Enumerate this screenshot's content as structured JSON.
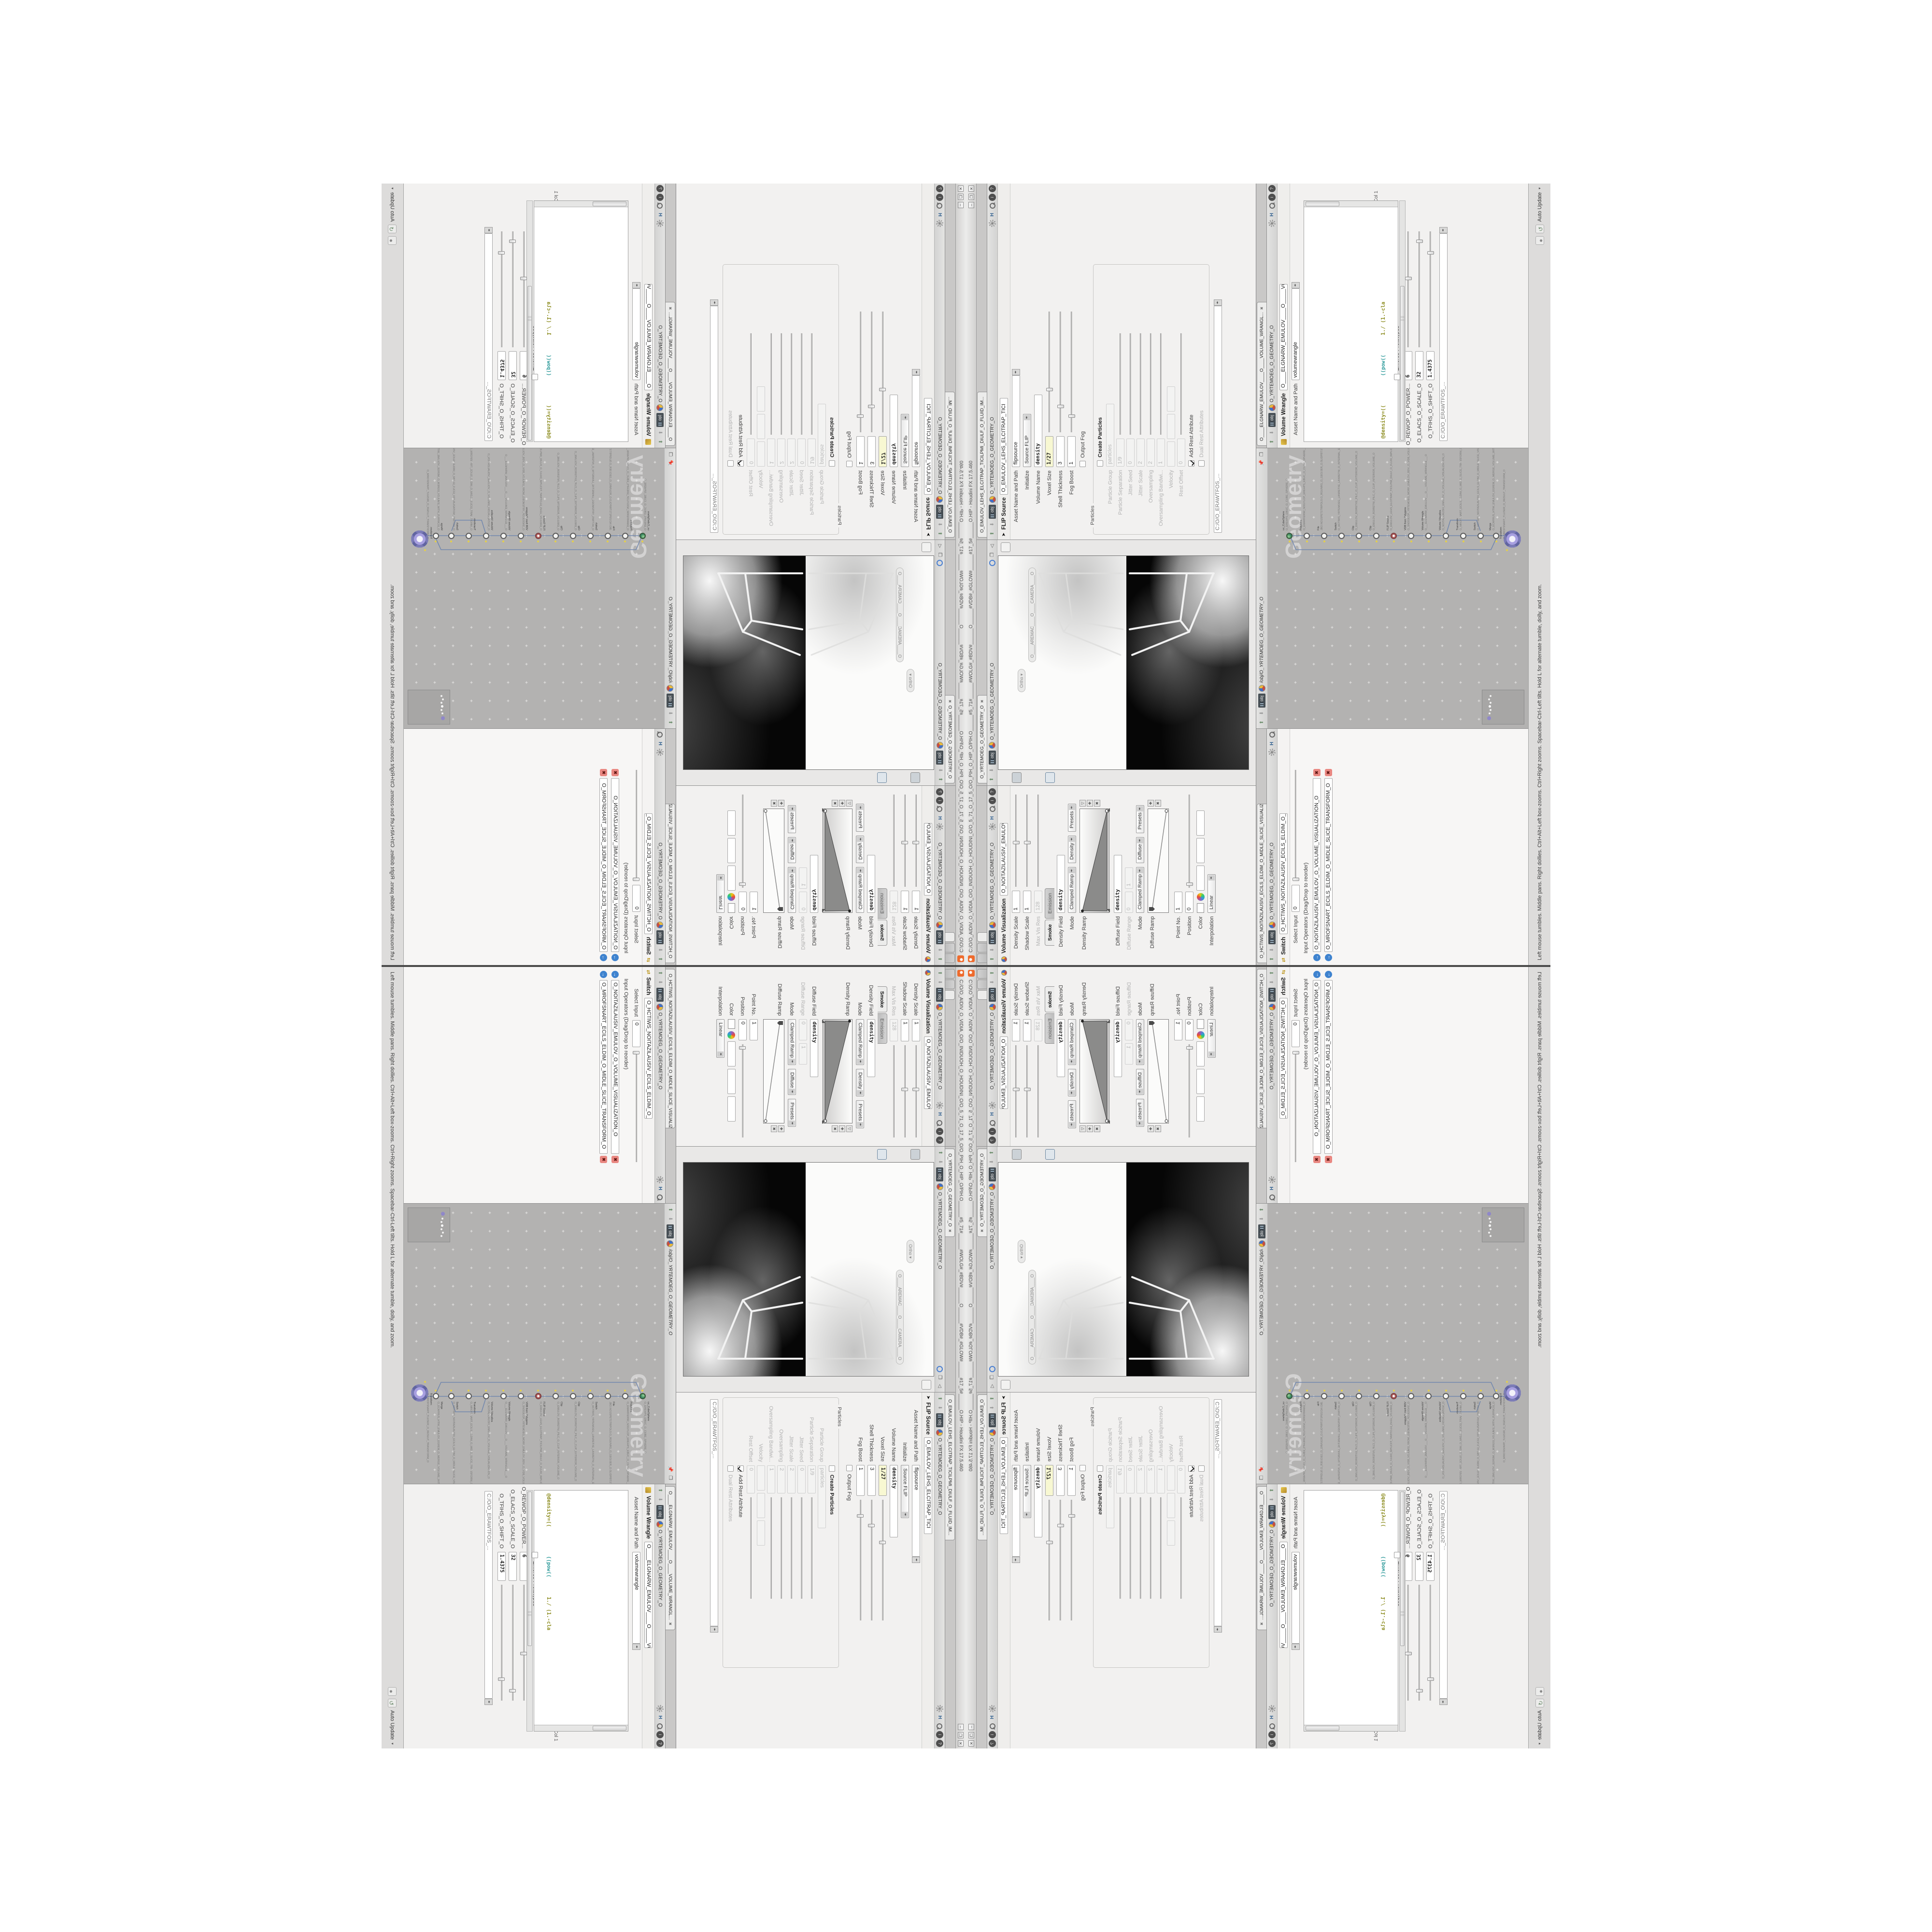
{
  "window": {
    "title": "C:/O/O_AIDIV_O_VIDIA_O/O_INIDUOH_O_HOUDINI_O/O_5_71_O_17_5_O/O_PIH_O_HIP_O/PIH.O______#5_71#______#WOLG#_#BDV#______O______#VDB#_#GLOW#______#17_5#______O.HIP - Houdini FX 17.5.460",
    "btn_min": "–",
    "btn_max": "❐",
    "btn_close": "✕"
  },
  "helpbar": {
    "hint": "Left mouse tumbles.  Middle pans.  Right dollies.  Ctrl+Alt+Left box-zooms.  Ctrl+Right zooms.  Spacebar-Ctrl-Left tilts.  Hold L for alternate tumble, dolly, and zoom.",
    "auto_update": "Auto Update"
  },
  "paths": {
    "obj": "obj",
    "geometry": "O_YRTEMOEG_O_GEOMETRY_O",
    "network_path": "/obj/O_YRTEMOEG_O_GEOMETRY_O",
    "software_path": "C:/O/O_ERAWTFOS_...",
    "h_badge": "H"
  },
  "param_tabs": [
    {
      "t": "O____ARTNAM____O..."
    },
    {
      "t": "O____AREMAC____O..."
    },
    {
      "t": "O_NOITAZILAUSIV_E...",
      "cls": "on"
    }
  ],
  "volviz": {
    "tab": "O_NOITAZILAUSIV_E...",
    "title": "Volume Visualization",
    "name": "O_NOITAZILAUSIV_EMULOV_O_VO",
    "density_scale_label": "Density Scale",
    "density_scale": "1",
    "shadow_scale_label": "Shadow Scale",
    "shadow_scale": "1",
    "maxvisres_label": "Max Vis Res",
    "maxvisres": "128",
    "folder_tabs": [
      "Smoke",
      "Emission"
    ],
    "density_field_label": "Density Field",
    "density_field": "density",
    "mode_label": "Mode",
    "mode": "Clamped Ramp",
    "density_btn": "Density",
    "diffuse_btn": "Diffuse",
    "presets_btn": "Presets",
    "density_ramp_label": "Density Ramp",
    "diffuse_field_label": "Diffuse Field",
    "diffuse_field": "density",
    "diffuse_range_label": "Diffuse Range",
    "diffuse_range_min": "0",
    "diffuse_range_max": "1",
    "diffuse_ramp_label": "Diffuse Ramp",
    "point_no_label": "Point No.",
    "point_no": "1",
    "position_label": "Position",
    "position": "0",
    "color_label": "Color",
    "color_vals": [
      "1.8125",
      "1.8125",
      "1.8125"
    ],
    "interp_label": "Interpolation",
    "interp": "Linear"
  },
  "viewport": {
    "tab": "O_YRTEMOEG_O_GEOMETRY_O",
    "pill_ortho": "Ortho ▾",
    "pill_camera": "O____AREMAC____O____CAMERA____O",
    "left_toolbar": [
      {
        "g": "●",
        "style": "color:#e3c44c"
      },
      {
        "g": "◆",
        "style": "color:#7f96a8;background:#ccd2d7;border:1px solid #8a8a8a"
      },
      {
        "g": "●",
        "style": "color:#d9b93f"
      },
      {
        "g": "▸",
        "style": "color:#f6f6f6;text-shadow:0 0 1px #666"
      },
      {
        "g": "D",
        "style": "color:#46688c;border:1px solid #6c87a0;background:#dfe6ec;font-size:10px"
      },
      {
        "g": "◎",
        "style": "color:#b04a38"
      },
      {
        "g": "►",
        "style": "color:#b04a38"
      },
      {
        "g": "✚",
        "style": "color:#53a253"
      },
      {
        "g": "∪",
        "style": "color:#c23d2e;font-weight:bold"
      },
      {
        "g": "∪",
        "style": "color:#c23d2e;font-weight:bold"
      },
      {
        "g": "∪",
        "style": "color:#c23d2e;font-weight:bold"
      },
      {
        "g": "∪",
        "style": "color:#c23d2e;font-weight:bold"
      },
      {
        "g": "✎",
        "style": "color:#8a8a8a"
      },
      {
        "g": "◉",
        "style": "color:#777"
      }
    ],
    "right_toolbar": [
      {
        "g": "▭",
        "style": "color:#555;border:1px solid #9a9a9a;background:#f2f2f1"
      },
      {
        "g": "●",
        "style": "color:#3f6fae"
      },
      {
        "g": "■",
        "style": "color:#7e9ab5"
      },
      {
        "g": "◎",
        "style": "color:#4a7fd1"
      },
      {
        "g": "▲",
        "style": "color:#8a8a89"
      },
      {
        "g": "●",
        "style": "color:#e0c454"
      },
      {
        "g": "◆",
        "style": "color:#97a5b2"
      },
      {
        "g": "●",
        "style": "color:#e0c454"
      },
      {
        "g": "□",
        "style": "color:#666"
      },
      {
        "g": "◉",
        "style": "color:#5588bb"
      }
    ]
  },
  "network": {
    "path": "/obj/O_YRTEMOEG_O_GEOMETRY_O",
    "watermark": "Geometry",
    "nodes": [
      {
        "type": "uv_CubeSphere",
        "name": "O_EREHPS_EBUC_O_CUBE_SPHERE_O",
        "style": "top:38px",
        "cls": "globe"
      },
      {
        "type": "PolyWire",
        "name": "O_EMARFERIW_NOGYLOP_EREHPS_EBUC_O_CUBE_SPHERE_POLYGON_WIREFRAME_O",
        "style": "top:74px"
      },
      {
        "type": "File",
        "name": "JBO.NO1SPET1TRIPOLS.O_RGUNRG_O_GEO/JER_O.SLIDPBT.STEP.3014.OBJ",
        "style": "top:110px"
      },
      {
        "type": "Switch",
        "name": "O_HCTIWS_YRTEMOEG_LANRETXE_LANRETNI_O_INTERNAL_EXTERNAL_GEOMETRY_SWITCH_O",
        "style": "top:146px"
      },
      {
        "type": "Clip",
        "name": "O_EMULOV_ROIRETXE_PILC_O_CLIP_EXTERIOR_VOLUME_O",
        "style": "top:182px"
      },
      {
        "type": "Clip",
        "name": "O_EMULOV_ROIRETNI_PILC_O_CLIP_INTERIOR_VOLUME_O",
        "style": "top:218px"
      },
      {
        "type": "FLIP Source",
        "name": "O_EMULOV_LEHS_ELCITRAP_TICILPMI_DIULF_O_FLUID_IMPLICIT_PARTICLE_SHEL_VOLUME_O",
        "style": "top:254px",
        "cls": "ring"
      },
      {
        "type": "VDB from Polygons",
        "name": "O_SNOGILOP_YRTEMOEG_MORF_EMULOV_BDV_O_VDB_VOLUME_FROM_GEOMETRY_POLYGONS_O",
        "style": "top:290px"
      },
      {
        "type": "Volume Wrangle",
        "name": "O___ELGNARW_EMULOV___O___VOLUME_WRANGLE___O",
        "style": "top:326px"
      },
      {
        "type": "Volume Visualiza",
        "name": "O_NOITAZILAUSIV_EMULOV_O_VOLUME_VISUALIZATION_O",
        "style": "top:362px"
      },
      {
        "type": "Transform",
        "name": "O_MROFSNART_ECILS_ELDIM_O_MIDLE_SLICE_TRANSFORM_O",
        "style": "top:398px"
      },
      {
        "type": "Switch",
        "name": "O_HCTIWS_NOITAZILAUSIV_ECILS_ELDIM_O_MIDLE_SLICE_VISUALIZATION_SWITCH_O",
        "style": "top:434px"
      },
      {
        "type": "Merge",
        "name": "O_ECAFRUS_HTIW_EMULOV_EGREM_O_MERGE_VOLUME_WITH_SURFACE_O",
        "style": "top:466px"
      },
      {
        "type": "Transform",
        "name": "O_MROFSNART_TLUSER_O_RESULT_TRANSFORM_O",
        "style": "top:488px",
        "cls": "big"
      }
    ]
  },
  "switch_pane": {
    "tab": "O_HCTIWS_NOITAZILAUSIV_ECILS_ELDIM_O_MIDLE_SLICE_VISUALIZATION...",
    "title": "Switch",
    "name": "O_HCTIWS_NOITAZILAUSIV_ECILS_ELDIM_O_",
    "select_input_label": "Select Input",
    "select_input": "0",
    "list_label": "Input Operators (Drag/Drop to reorder)",
    "items": [
      {
        "t": "O_NOITAZILAUSIV_EMULOV_O_VOLUME_VISUALIZATION_O"
      },
      {
        "t": "O_MROFSNART_ECILS_ELDIM_O_MIDLE_SLICE_TRANSFORM_O"
      }
    ],
    "arrow": "→",
    "x": "✖"
  },
  "flip": {
    "tab": "O_EMULOV_LEHS_ELCITRAP_TICILPMI_DIULF_O_FLUID_IM...",
    "title": "FLIP Source",
    "name": "O_EMULOV_LEHS_ELCITRAP_TICI",
    "asset_label": "Asset Name and Path",
    "asset": "flipsource",
    "initialize_label": "Initialize",
    "initialize": "Source FLIP",
    "volume_name_label": "Volume Name",
    "volume_name": "density",
    "voxel_size_label": "Voxel Size",
    "voxel_size": "1/27",
    "shell_label": "Shell Thickness",
    "shell": "3",
    "fog_boost_label": "Fog Boost",
    "fog_boost": "1",
    "output_fog_label": "Output Fog",
    "particles_group": "Particles",
    "create_particles_label": "Create Particles",
    "particle_group_label": "Particle Group",
    "particle_group": "particles",
    "particle_sep_label": "Particle Separation",
    "particle_sep": "1/9",
    "jitter_seed_label": "Jitter Seed",
    "jitter_seed": "0",
    "jitter_scale_label": "Jitter Scale",
    "jitter_scale": "2",
    "oversampling_label": "Oversampling",
    "oversampling": "2",
    "oversampling_bw_label": "Oversampling Bandwi...",
    "oversampling_bw": "1",
    "velocity_label": "Velocity",
    "velocity": [
      "0",
      "0",
      "0"
    ],
    "rest_offset_label": "Rest Offset",
    "rest_offset": "0",
    "add_rest_label": "Add Rest Attribute",
    "dual_rest_label": "Dual Rest Attributes"
  },
  "wrangle": {
    "tab": "O____ELGNARW_EMULOV____O____VOLUME_WRANGL...",
    "title": "Volume Wrangle",
    "name": "O____ELGNARW_EMULOV____O_____VO",
    "asset_label": "Asset Name and Path",
    "asset": "volumewrangle",
    "code_lines": [
      {
        "t": "/// ◎ 0D3%steserPym62%0D3%eziSym62%000.1D3%C62%000."
      },
      {
        "t": "/// ◎ 0D3%steserPym62%0D3%eziSym62%000.1D3%C62%000."
      },
      {
        "t": "/// ◎ \\\\\\"
      },
      {
        "t": "/// ◎ HTTP://MEMORYST◎MP.C◎M/graphtoy/#draw1%3Dtru"
      },
      {
        "t": "/// ◎ HTTP://MEMORYST◎MP.C◎M/graphtoy/#draw1%3Dtru"
      },
      {
        "t": ""
      }
    ],
    "code7a": "@density=((",
    "code7b": "((pow((",
    "code7c": "1./ (1.-cla",
    "status": "Ln 209, Col 1",
    "volumes_label": "Volumes to Write to",
    "volumes": "*",
    "enforce_label": "Enforce Prototypes",
    "power_label": "O_REWOP_O_POWER...",
    "power": "6",
    "scale_label": "O_ELACS_O_SCALE_O",
    "scale": "32",
    "shift_label": "O_TFIHS_O_SHIFT_O",
    "shift": "1.4375"
  }
}
